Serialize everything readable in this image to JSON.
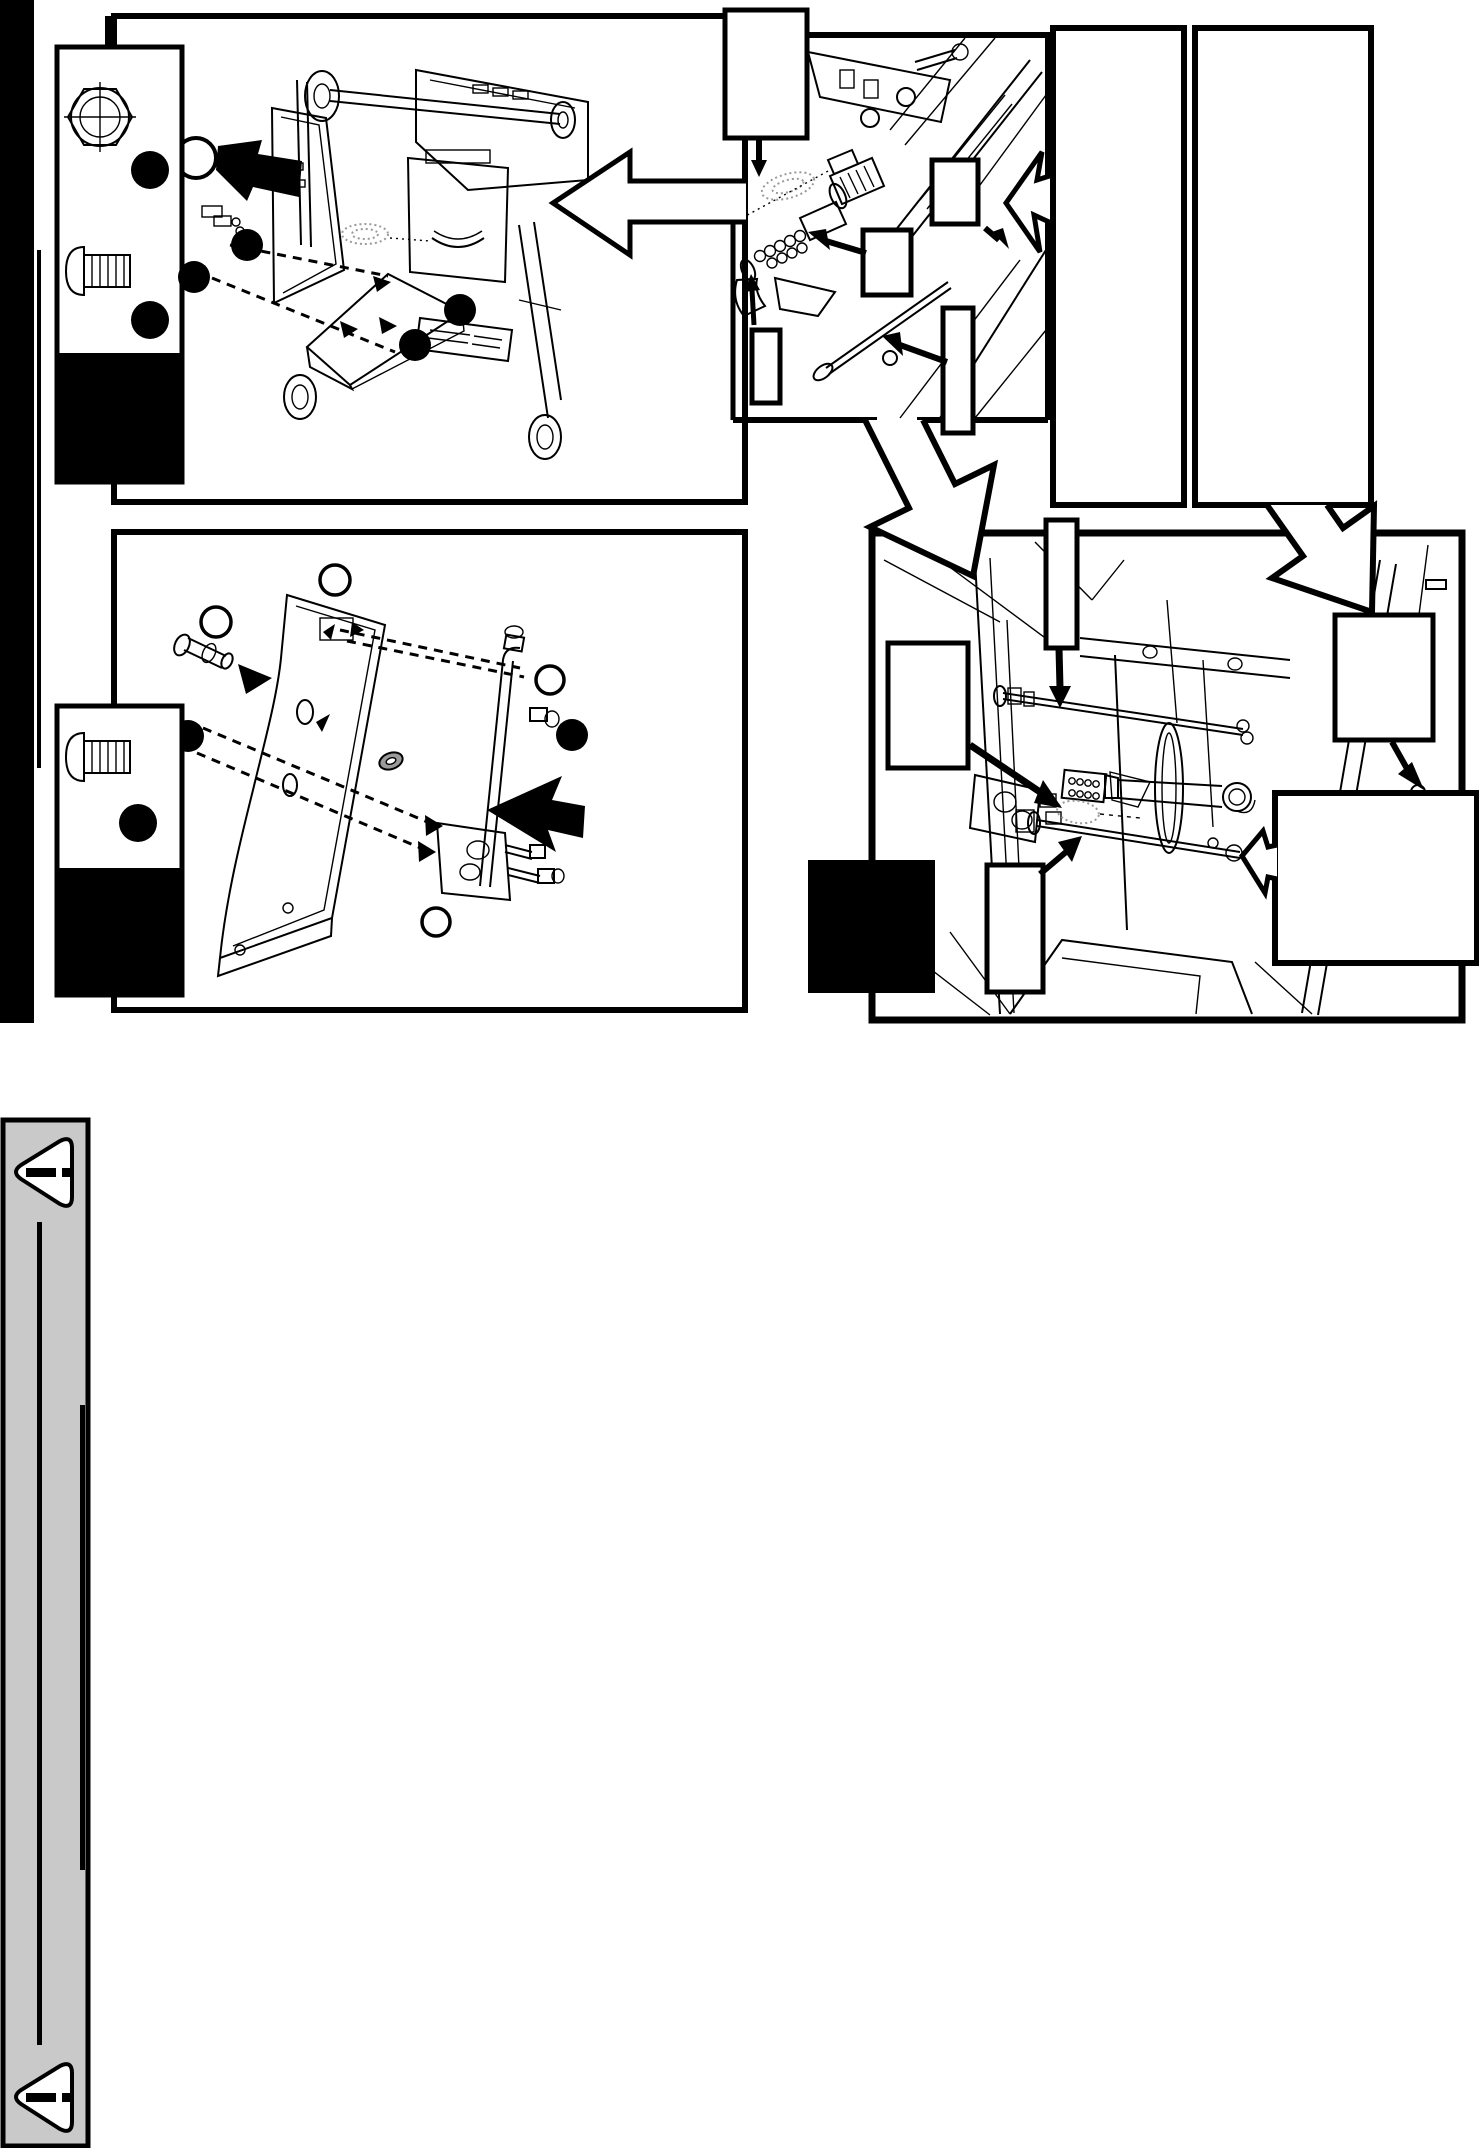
{
  "document": {
    "type": "assembly-manual-page",
    "page_background": "#ffffff",
    "width_px": 1479,
    "height_px": 2148
  },
  "colors": {
    "ink": "#000000",
    "paper": "#ffffff",
    "sidebar_gray": "#c9c9c9",
    "shading_gray": "#9a9a9a"
  },
  "sidebar_strip": {
    "warning_top": {
      "icon": "warning-triangle-icon",
      "glyph": "!",
      "direction": "left"
    },
    "warning_bottom": {
      "icon": "warning-triangle-icon",
      "glyph": "!",
      "direction": "left"
    },
    "rule_lines": 2
  },
  "hardware_legends": [
    {
      "id": "top-left",
      "icons": [
        "hex-nut-icon",
        "pan-head-bolt-icon"
      ],
      "callout_dot_count": 2,
      "has_black_footer": true
    },
    {
      "id": "middle-left",
      "icons": [
        "pan-head-bolt-icon"
      ],
      "callout_dot_count": 1,
      "has_black_footer": true
    }
  ],
  "panels": [
    {
      "id": "top-left",
      "content": "cart-frame-exploded-view",
      "callout_dot_count": 4,
      "empty_circle_count": 1
    },
    {
      "id": "top-right-detail",
      "content": "venturi-valve-close-up",
      "empty_callout_box_count": 5
    },
    {
      "id": "middle-left",
      "content": "side-panel-valve-exploded-view",
      "callout_dot_count": 2,
      "empty_circle_count": 4
    },
    {
      "id": "bottom-right",
      "content": "burner-interior-close-up",
      "empty_callout_box_count": 6,
      "solid_black_box_count": 1
    }
  ],
  "reference_boxes": {
    "tall_empty_boxes_top_right": 2
  },
  "arrows": {
    "hollow_count": 5,
    "solid_count": 12
  }
}
